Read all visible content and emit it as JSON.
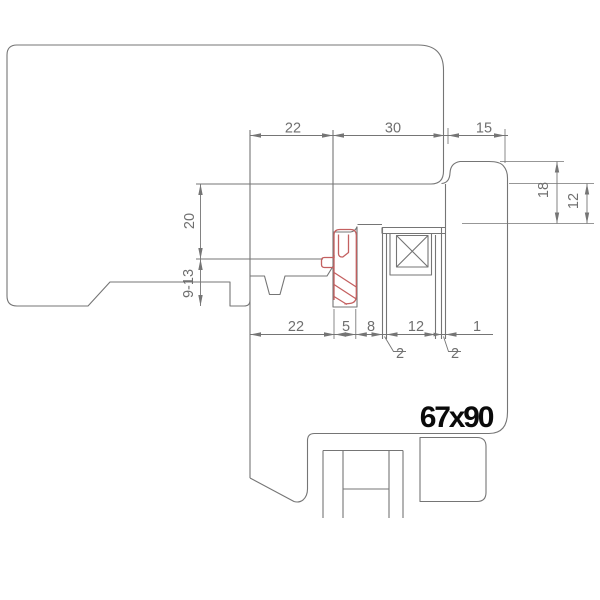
{
  "drawing": {
    "product_label": "67x90",
    "dimensions": {
      "top": {
        "d1": "22",
        "d2": "30",
        "d3": "15"
      },
      "left": {
        "d1": "20",
        "d2": "9-13"
      },
      "right": {
        "d1": "18",
        "d2": "12"
      },
      "bottom": {
        "d1": "22",
        "d2": "5",
        "d3": "8",
        "d4": "12",
        "d5": "1"
      },
      "callouts": {
        "c1": "2",
        "c2": "2"
      }
    },
    "colors": {
      "line": "#757575",
      "text": "#6f6f6f",
      "seal": "#c46060",
      "label": "#0a0a0a",
      "background": "#ffffff"
    }
  }
}
